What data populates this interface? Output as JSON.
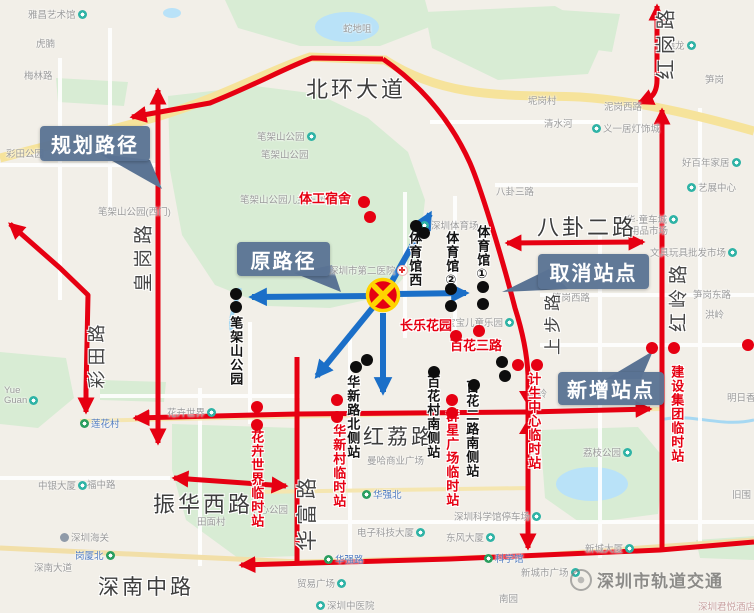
{
  "title": "深圳公交线路调整示意图",
  "colors": {
    "route_red": "#e60012",
    "arrow_blue": "#1b6fc8",
    "callout_bg": "#5b7494",
    "closure_yellow": "#ffd400",
    "park_green": "#d8ecd4",
    "water_blue": "#b9e2f8",
    "highway_yellow": "#f6e39b"
  },
  "callouts": {
    "planned": {
      "label": "规划路径"
    },
    "original": {
      "label": "原路径"
    },
    "cancelled": {
      "label": "取消站点"
    },
    "added": {
      "label": "新增站点"
    }
  },
  "watermark": {
    "text": "深圳市轨道交通"
  },
  "map": {
    "big_roads": [
      {
        "t": "北环大道",
        "x": 306,
        "y": 72,
        "fs": 22
      },
      {
        "t": "八卦二路",
        "x": 537,
        "y": 210,
        "fs": 22
      },
      {
        "t": "红荔路",
        "x": 363,
        "y": 421,
        "fs": 21
      },
      {
        "t": "振华西路",
        "x": 153,
        "y": 487,
        "fs": 22
      },
      {
        "t": "深南中路",
        "x": 98,
        "y": 571,
        "fs": 21
      }
    ],
    "rotated_roads": [
      {
        "t": "皇岗路",
        "x": 142,
        "y": 256,
        "fs": 19
      },
      {
        "t": "彩田路",
        "x": 96,
        "y": 354,
        "fs": 18
      },
      {
        "t": "红岗路",
        "x": 664,
        "y": 42,
        "fs": 20
      },
      {
        "t": "红岭路",
        "x": 677,
        "y": 296,
        "fs": 19
      },
      {
        "t": "上步路",
        "x": 551,
        "y": 322,
        "fs": 17
      },
      {
        "t": "华富路",
        "x": 306,
        "y": 512,
        "fs": 21
      }
    ],
    "pois": [
      {
        "t": "雅昌艺术馆",
        "x": 28,
        "y": 7,
        "i": "poi",
        "p": "a"
      },
      {
        "t": "虎腩",
        "x": 36,
        "y": 36
      },
      {
        "t": "梅林路",
        "x": 24,
        "y": 68
      },
      {
        "t": "彩田公园",
        "x": 6,
        "y": 146
      },
      {
        "t": "蛇地咀",
        "x": 343,
        "y": 21
      },
      {
        "t": "笔架山公园",
        "x": 257,
        "y": 129,
        "i": "poi",
        "p": "a"
      },
      {
        "t": "笔架山公园",
        "x": 261,
        "y": 147
      },
      {
        "t": "笔架山公园(西门)",
        "x": 98,
        "y": 204
      },
      {
        "t": "笔架山公园儿童乐园",
        "x": 240,
        "y": 192
      },
      {
        "t": "深圳市第二医院",
        "x": 329,
        "y": 263,
        "i": "hosp",
        "p": "a"
      },
      {
        "t": "深圳体育场",
        "x": 420,
        "y": 218,
        "i": "poi",
        "p": "b"
      },
      {
        "t": "宝宝儿童乐园",
        "x": 446,
        "y": 315,
        "i": "poi",
        "p": "a"
      },
      {
        "t": "坭岗村",
        "x": 528,
        "y": 93
      },
      {
        "t": "清水河",
        "x": 544,
        "y": 116
      },
      {
        "t": "义一居灯饰城",
        "x": 592,
        "y": 121,
        "i": "poi",
        "p": "b"
      },
      {
        "t": "泥岗西路",
        "x": 604,
        "y": 99
      },
      {
        "t": "笋岗",
        "x": 705,
        "y": 72
      },
      {
        "t": "麦德龙",
        "x": 656,
        "y": 38,
        "i": "poi",
        "p": "a"
      },
      {
        "t": "好百年家居",
        "x": 682,
        "y": 155,
        "i": "poi",
        "p": "a"
      },
      {
        "t": "艺展中心",
        "x": 687,
        "y": 180,
        "i": "poi",
        "p": "b"
      },
      {
        "t": "八卦三路",
        "x": 496,
        "y": 184
      },
      {
        "t": "华·童车城",
        "x": 626,
        "y": 212,
        "i": "poi",
        "p": "a"
      },
      {
        "t": "用品市场",
        "x": 630,
        "y": 223
      },
      {
        "t": "文具玩具批发市场",
        "x": 650,
        "y": 245,
        "i": "poi",
        "p": "a"
      },
      {
        "t": "笋岗西路",
        "x": 552,
        "y": 290
      },
      {
        "t": "笋岗东路",
        "x": 693,
        "y": 287
      },
      {
        "t": "洪岭",
        "x": 705,
        "y": 307
      },
      {
        "t": "园岭",
        "x": 528,
        "y": 386
      },
      {
        "t": "曼哈商业广场",
        "x": 367,
        "y": 453
      },
      {
        "t": "华强北",
        "x": 362,
        "y": 487,
        "i": "metro",
        "p": "b",
        "c": "metro"
      },
      {
        "t": "电子科技大厦",
        "x": 357,
        "y": 525,
        "i": "poi",
        "p": "a"
      },
      {
        "t": "东风大厦",
        "x": 446,
        "y": 530,
        "i": "poi",
        "p": "a"
      },
      {
        "t": "深圳科学馆停车场",
        "x": 454,
        "y": 509,
        "i": "poi",
        "p": "a"
      },
      {
        "t": "科学馆",
        "x": 484,
        "y": 551,
        "i": "metro",
        "p": "b",
        "c": "metro"
      },
      {
        "t": "华强路",
        "x": 324,
        "y": 552,
        "i": "metro",
        "p": "b",
        "c": "metro"
      },
      {
        "t": "新城市广场",
        "x": 521,
        "y": 565,
        "i": "poi",
        "p": "a"
      },
      {
        "t": "新城大厦",
        "x": 585,
        "y": 541,
        "i": "poi",
        "p": "a"
      },
      {
        "t": "南园",
        "x": 499,
        "y": 591
      },
      {
        "t": "深圳中医院",
        "x": 316,
        "y": 598,
        "i": "poi",
        "p": "b"
      },
      {
        "t": "贸易广场",
        "x": 297,
        "y": 576,
        "i": "poi",
        "p": "a"
      },
      {
        "t": "深圳君悦酒店",
        "x": 698,
        "y": 599,
        "c": "pink"
      },
      {
        "t": "中银大厦",
        "x": 38,
        "y": 478,
        "i": "poi",
        "p": "a"
      },
      {
        "t": "深圳海关",
        "x": 60,
        "y": 530,
        "i": "pin",
        "p": "b"
      },
      {
        "t": "岗厦北",
        "x": 75,
        "y": 548,
        "i": "metro",
        "p": "a",
        "c": "metro"
      },
      {
        "t": "深南大道",
        "x": 34,
        "y": 560
      },
      {
        "t": "福中路",
        "x": 87,
        "y": 477
      },
      {
        "t": "田面村",
        "x": 197,
        "y": 514
      },
      {
        "t": "中心公园",
        "x": 250,
        "y": 502
      },
      {
        "t": "花卉世界",
        "x": 167,
        "y": 405,
        "i": "poi",
        "p": "a"
      },
      {
        "t": "莲花村",
        "x": 80,
        "y": 416,
        "i": "metro",
        "p": "b",
        "c": "metro"
      },
      {
        "t": "Yue",
        "x": 4,
        "y": 385
      },
      {
        "t": "Guan",
        "x": 4,
        "y": 395,
        "i": "poi",
        "p": "a"
      },
      {
        "t": "荔枝公园",
        "x": 583,
        "y": 445,
        "i": "poi",
        "p": "a"
      },
      {
        "t": "明日香",
        "x": 727,
        "y": 390
      },
      {
        "t": "旧围",
        "x": 732,
        "y": 487
      }
    ]
  },
  "stations": {
    "labels": [
      {
        "t": "笔架山公园",
        "x": 228,
        "y": 316,
        "dir": "v",
        "color": "b"
      },
      {
        "t": "体育馆西",
        "x": 407,
        "y": 231,
        "dir": "v",
        "color": "b"
      },
      {
        "t": "体育馆②",
        "x": 444,
        "y": 231,
        "dir": "v",
        "color": "b"
      },
      {
        "t": "体育馆①",
        "x": 475,
        "y": 225,
        "dir": "v",
        "color": "b"
      },
      {
        "t": "华新路北侧站",
        "x": 345,
        "y": 375,
        "dir": "v",
        "color": "b"
      },
      {
        "t": "百花村南侧站",
        "x": 425,
        "y": 375,
        "dir": "v",
        "color": "b"
      },
      {
        "t": "百花二路南侧站",
        "x": 464,
        "y": 380,
        "dir": "v",
        "color": "b"
      },
      {
        "t": "花卉世界临时站",
        "x": 249,
        "y": 430,
        "dir": "v",
        "color": "r"
      },
      {
        "t": "华新村临时站",
        "x": 331,
        "y": 424,
        "dir": "v",
        "color": "r"
      },
      {
        "t": "群星广场临时站",
        "x": 444,
        "y": 409,
        "dir": "v",
        "color": "r"
      },
      {
        "t": "计生中心临时站",
        "x": 526,
        "y": 372,
        "dir": "v",
        "color": "r"
      },
      {
        "t": "建设集团临时站",
        "x": 669,
        "y": 365,
        "dir": "v",
        "color": "r"
      },
      {
        "t": "体工宿舍",
        "x": 299,
        "y": 192,
        "dir": "h",
        "color": "r"
      },
      {
        "t": "长乐花园",
        "x": 400,
        "y": 319,
        "dir": "h",
        "color": "r"
      },
      {
        "t": "百花三路",
        "x": 450,
        "y": 339,
        "dir": "h",
        "color": "r"
      }
    ],
    "cancelled_dots": [
      [
        236,
        294
      ],
      [
        236,
        307
      ],
      [
        416,
        226
      ],
      [
        424,
        233
      ],
      [
        451,
        289
      ],
      [
        451,
        306
      ],
      [
        483,
        287
      ],
      [
        483,
        304
      ],
      [
        356,
        367
      ],
      [
        367,
        360
      ],
      [
        434,
        372
      ],
      [
        474,
        385
      ],
      [
        502,
        362
      ],
      [
        505,
        376
      ]
    ],
    "new_dots": [
      [
        364,
        202
      ],
      [
        370,
        217
      ],
      [
        456,
        336
      ],
      [
        479,
        331
      ],
      [
        518,
        365
      ],
      [
        537,
        365
      ],
      [
        452,
        400
      ],
      [
        452,
        413
      ],
      [
        337,
        400
      ],
      [
        337,
        417
      ],
      [
        257,
        407
      ],
      [
        257,
        425
      ],
      [
        652,
        348
      ],
      [
        674,
        348
      ],
      [
        748,
        345
      ]
    ]
  }
}
